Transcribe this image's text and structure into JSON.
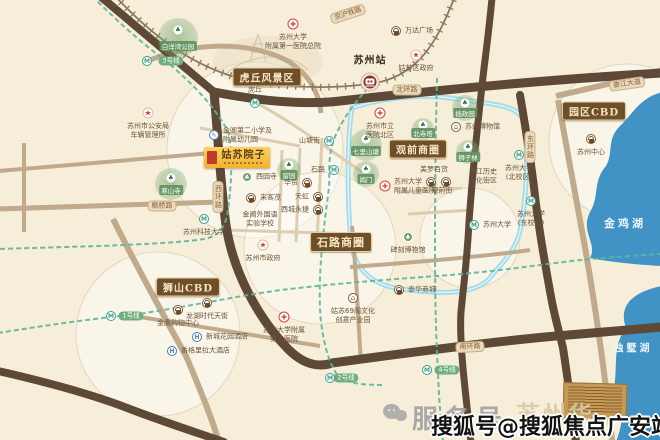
{
  "property": {
    "name": "姑苏院子"
  },
  "banners": [
    {
      "id": "huqiu-scenic-area",
      "label": "虎丘风景区",
      "x": 267,
      "y": 77,
      "fs": 10
    },
    {
      "id": "guanqian-business-circle",
      "label": "观前商圈",
      "x": 418,
      "y": 149,
      "fs": 10
    },
    {
      "id": "shilu-business-circle",
      "label": "石路商圈",
      "x": 341,
      "y": 242,
      "fs": 11
    },
    {
      "id": "shishan-cbd",
      "label": "狮山CBD",
      "x": 188,
      "y": 287,
      "fs": 10
    },
    {
      "id": "yuanqu-cbd",
      "label": "园区CBD",
      "x": 594,
      "y": 111,
      "fs": 10
    }
  ],
  "road_labels": [
    {
      "id": "beihuan-road",
      "label": "北环路",
      "x": 407,
      "y": 90,
      "vert": false,
      "rot": 0
    },
    {
      "id": "xihuan-road",
      "label": "西环路",
      "x": 218,
      "y": 197,
      "vert": true,
      "rot": 0
    },
    {
      "id": "donghuan-road",
      "label": "东环路",
      "x": 530,
      "y": 147,
      "vert": true,
      "rot": 0
    },
    {
      "id": "nanhuan-road",
      "label": "南环路",
      "x": 470,
      "y": 347,
      "vert": false,
      "rot": -3
    },
    {
      "id": "fengqiao-road",
      "label": "枫桥路",
      "x": 162,
      "y": 206,
      "vert": false,
      "rot": 0
    },
    {
      "id": "jinghu-railway",
      "label": "京沪铁路",
      "x": 348,
      "y": 14,
      "vert": false,
      "rot": -18
    },
    {
      "id": "loujiang-avenue",
      "label": "娄江大道",
      "x": 627,
      "y": 84,
      "vert": false,
      "rot": -8
    }
  ],
  "metro_pills": [
    {
      "id": "metro-line-3",
      "label": "3号线",
      "x": 171,
      "y": 61,
      "ix": 147,
      "iy": 61
    },
    {
      "id": "metro-line-1",
      "label": "1号线",
      "x": 131,
      "y": 316,
      "ix": 111,
      "iy": 316
    },
    {
      "id": "metro-line-2",
      "label": "2号线",
      "x": 346,
      "y": 378,
      "ix": 330,
      "iy": 378
    },
    {
      "id": "metro-line-4",
      "label": "4号线",
      "x": 447,
      "y": 370,
      "ix": 427,
      "iy": 370
    }
  ],
  "lakes": [
    {
      "id": "jinji-lake",
      "label": "金鸡湖",
      "x": 625,
      "y": 223
    },
    {
      "id": "dushu-lake",
      "label": "独墅湖",
      "x": 633,
      "y": 347
    }
  ],
  "pois": [
    {
      "id": "baiyangwan-park",
      "type": "park",
      "x": 178,
      "y": 38,
      "r": 20,
      "lines": [
        "白洋湾公园"
      ]
    },
    {
      "id": "hanshan-temple",
      "type": "park",
      "x": 171,
      "y": 184,
      "r": 16,
      "lines": [
        "寒山寺"
      ]
    },
    {
      "id": "liuyuan-garden",
      "type": "park",
      "x": 289,
      "y": 170,
      "r": 12,
      "lines": [
        "留园"
      ]
    },
    {
      "id": "qili-shantang",
      "type": "park",
      "x": 366,
      "y": 145,
      "r": 16,
      "lines": [
        "七里山塘"
      ]
    },
    {
      "id": "changmen-gate",
      "type": "park",
      "x": 366,
      "y": 174,
      "r": 13,
      "lines": [
        "阊门"
      ]
    },
    {
      "id": "beisi-pagoda",
      "type": "park",
      "x": 423,
      "y": 129,
      "r": 11,
      "lines": [
        "北寺塔"
      ]
    },
    {
      "id": "zhuozheng-garden",
      "type": "park",
      "x": 465,
      "y": 108,
      "r": 13,
      "lines": [
        "拙政园"
      ]
    },
    {
      "id": "shizilin-garden",
      "type": "park",
      "x": 468,
      "y": 152,
      "r": 12,
      "lines": [
        "狮子林"
      ]
    },
    {
      "id": "huqiu-station",
      "type": "metro",
      "x": 255,
      "y": 103,
      "side": "above",
      "lines": [
        "虎丘"
      ]
    },
    {
      "id": "shantangjie-station",
      "type": "metro",
      "x": 329,
      "y": 141,
      "side": "left",
      "lines": [
        "山塘街"
      ]
    },
    {
      "id": "shilu-station",
      "type": "metro",
      "x": 334,
      "y": 170,
      "side": "left",
      "lines": [
        "石路"
      ]
    },
    {
      "id": "suzhou-tech-university",
      "type": "metro",
      "x": 204,
      "y": 219,
      "side": "below",
      "lines": [
        "苏州科技大学"
      ]
    },
    {
      "id": "soochow-university-north",
      "type": "metro",
      "x": 519,
      "y": 155,
      "side": "below",
      "lines": [
        "苏州大学",
        "(北校区)"
      ]
    },
    {
      "id": "soochow-university-east",
      "type": "metro",
      "x": 531,
      "y": 201,
      "side": "below",
      "lines": [
        "苏州大学",
        "(东校区)"
      ]
    },
    {
      "id": "soochow-university",
      "type": "metro",
      "x": 474,
      "y": 225,
      "side": "right",
      "lines": [
        "苏州大学"
      ]
    },
    {
      "id": "xiyuan-temple",
      "type": "parkmini",
      "x": 247,
      "y": 177,
      "side": "right",
      "lines": [
        "西园寺"
      ]
    },
    {
      "id": "suda-first-hospital",
      "type": "hospital",
      "x": 293,
      "y": 24,
      "side": "below",
      "lines": [
        "苏州大学",
        "附属第一医院总院"
      ]
    },
    {
      "id": "shili-hospital-north",
      "type": "hospital",
      "x": 380,
      "y": 113,
      "side": "below",
      "lines": [
        "苏州市立",
        "医院北区"
      ]
    },
    {
      "id": "children-hospital",
      "type": "hospital",
      "x": 385,
      "y": 186,
      "side": "right",
      "lines": [
        "苏州大学",
        "附属儿童医院"
      ]
    },
    {
      "id": "suda-second-hospital",
      "type": "hospital",
      "x": 284,
      "y": 317,
      "side": "below",
      "lines": [
        "苏州大学附属",
        "第二医院"
      ]
    },
    {
      "id": "gusu-district-gov",
      "type": "star",
      "x": 416,
      "y": 55,
      "side": "below",
      "lines": [
        "姑苏区政府"
      ]
    },
    {
      "id": "vehicle-admin-office",
      "type": "star",
      "x": 148,
      "y": 113,
      "side": "below",
      "lines": [
        "苏州市公安局",
        "车辆管理所"
      ]
    },
    {
      "id": "suzhou-city-gov",
      "type": "star",
      "x": 263,
      "y": 245,
      "side": "below",
      "lines": [
        "苏州市政府"
      ]
    },
    {
      "id": "suzhou-railway-station",
      "type": "train",
      "x": 370,
      "y": 82,
      "side": "above",
      "lines": [
        "苏州站"
      ],
      "big": true
    },
    {
      "id": "wanda-plaza",
      "type": "shop",
      "x": 396,
      "y": 31,
      "side": "right",
      "lines": [
        "万达广场"
      ]
    },
    {
      "id": "meiluo-department",
      "type": "text",
      "x": 434,
      "y": 170,
      "lines": [
        "美罗百货"
      ]
    },
    {
      "id": "guanqian-shop-1",
      "type": "shop",
      "x": 431,
      "y": 182,
      "side": "none",
      "lines": []
    },
    {
      "id": "guanqian-shop-2",
      "type": "shop",
      "x": 446,
      "y": 182,
      "side": "none",
      "lines": []
    },
    {
      "id": "guanqian-street",
      "type": "text",
      "x": 442,
      "y": 191,
      "lines": [
        "观前街"
      ]
    },
    {
      "id": "laikemao",
      "type": "shop",
      "x": 251,
      "y": 198,
      "side": "right",
      "lines": [
        "来客茂"
      ]
    },
    {
      "id": "huamao",
      "type": "shop",
      "x": 307,
      "y": 183,
      "side": "left",
      "lines": [
        "华贸"
      ]
    },
    {
      "id": "tianhong",
      "type": "shop",
      "x": 318,
      "y": 197,
      "side": "left",
      "lines": [
        "天虹"
      ]
    },
    {
      "id": "xicheng-yongjie",
      "type": "shop",
      "x": 318,
      "y": 210,
      "side": "left",
      "lines": [
        "西城永捷"
      ]
    },
    {
      "id": "jinying-shopping-center",
      "type": "shop",
      "x": 178,
      "y": 310,
      "side": "below",
      "lines": [
        "金鹰购物中心"
      ]
    },
    {
      "id": "longhu-times-street",
      "type": "shop",
      "x": 207,
      "y": 303,
      "side": "below",
      "lines": [
        "龙湖时代天街"
      ]
    },
    {
      "id": "taihua-mall",
      "type": "shop",
      "x": 399,
      "y": 290,
      "side": "right",
      "lines": [
        "泰华商城"
      ]
    },
    {
      "id": "suzhou-center",
      "type": "shop",
      "x": 591,
      "y": 139,
      "side": "below",
      "lines": [
        "苏州中心"
      ]
    },
    {
      "id": "xincheng-garden-hotel",
      "type": "hotel",
      "x": 197,
      "y": 337,
      "side": "right",
      "lines": [
        "新城花园酒店"
      ]
    },
    {
      "id": "shangri-la-hotel",
      "type": "hotel",
      "x": 172,
      "y": 351,
      "side": "right",
      "lines": [
        "香格里拉大酒店"
      ]
    },
    {
      "id": "jinchang-second-primary",
      "type": "school",
      "x": 214,
      "y": 135,
      "side": "right",
      "lines": [
        "金阊第二小学及",
        "附属幼儿园"
      ]
    },
    {
      "id": "jinchang-foreign-school",
      "type": "text",
      "x": 260,
      "y": 219,
      "lines": [
        "金阊外国语",
        "实验学校"
      ]
    },
    {
      "id": "suzhou-museum",
      "type": "museum",
      "x": 456,
      "y": 127,
      "side": "right",
      "lines": [
        "苏州博物馆"
      ]
    },
    {
      "id": "beike-museum",
      "type": "parkmini",
      "x": 408,
      "y": 237,
      "side": "below",
      "lines": [
        "碑刻博物馆"
      ]
    },
    {
      "id": "pingjiang-historic-district",
      "type": "text",
      "x": 483,
      "y": 176,
      "lines": [
        "平江历史",
        "文化街区"
      ]
    },
    {
      "id": "gusu-69-creative-park",
      "type": "museum",
      "x": 353,
      "y": 298,
      "side": "below",
      "lines": [
        "姑苏69阁文化",
        "创意产业园"
      ]
    }
  ],
  "watermark": {
    "wechat_label": "服务号",
    "faint_label": "苏州华",
    "sohu_label": "搜狐号@搜狐焦点广安站"
  },
  "colors": {
    "background": "#f7eeda",
    "road_dark": "#5d4935",
    "road_tan": "#c0aa8b",
    "water": "#4193c6",
    "moat": "#a3dbe8",
    "metro_line": "#5fb49d",
    "banner_bg": "#6f4e2a",
    "property_bg": "#f5bd3a",
    "seal_red": "#c0392b"
  }
}
